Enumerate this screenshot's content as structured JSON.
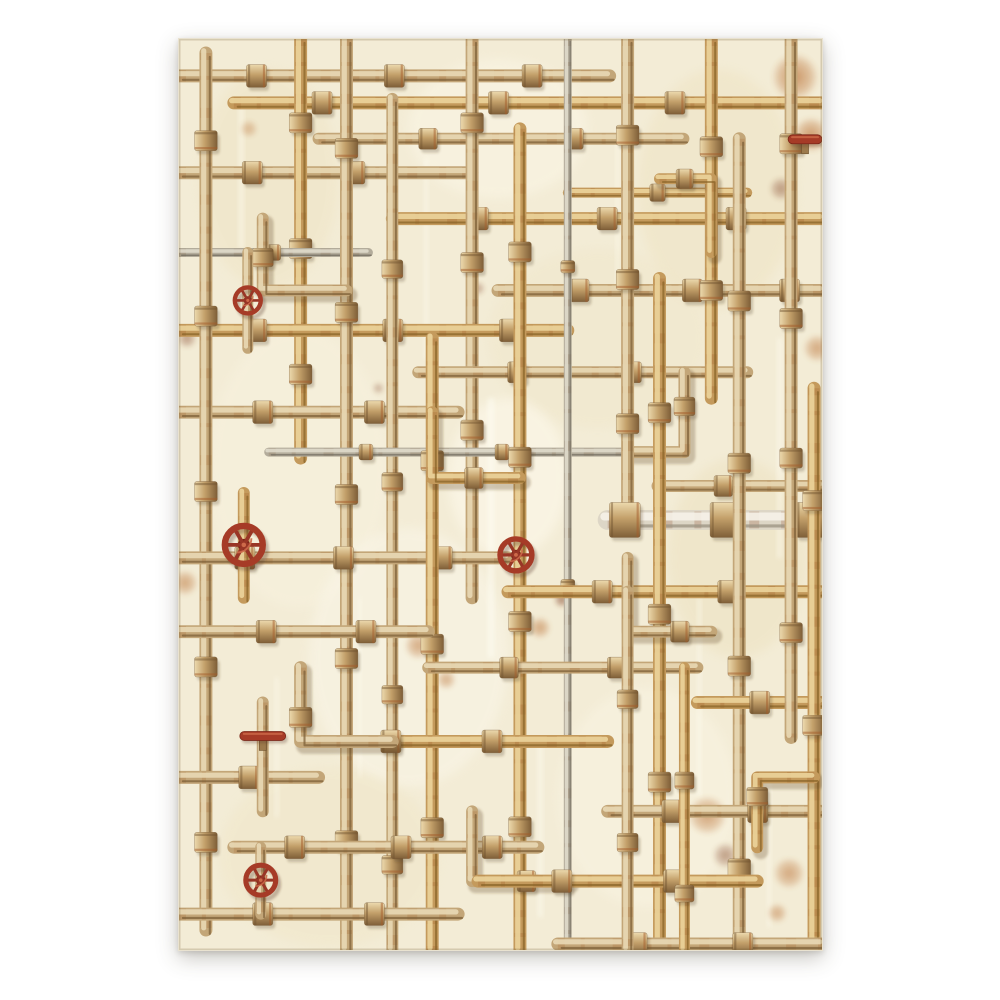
{
  "meta": {
    "description": "Decorative paper sheet with vintage rusty pipes, fittings and red valve wheels illustration on aged cream background"
  },
  "canvas": {
    "background": "#ffffff"
  },
  "sheet": {
    "x": 178,
    "y": 38,
    "width": 645,
    "height": 913,
    "background": "#f3ecd6"
  },
  "palette": {
    "tan": {
      "base": "#c3a678",
      "hi": "#e9d9b5",
      "dk": "#7d6038",
      "rust": "#a4622f"
    },
    "gold": {
      "base": "#c49a5c",
      "hi": "#ecd49b",
      "dk": "#8a6428",
      "rust": "#9c5526"
    },
    "gray": {
      "base": "#b3ac9b",
      "hi": "#dfdacb",
      "dk": "#6f6a5c",
      "rust": "#8a6a4a"
    },
    "white": {
      "base": "#ddd6c6",
      "hi": "#f6f2e8",
      "dk": "#9a9280",
      "rust": "#8d4526"
    },
    "valve_red": {
      "ring": "#a63b27",
      "dark": "#7c2718",
      "hi": "#cd6a4a"
    },
    "shadow": "rgba(92,70,40,0.28)",
    "stain_orange": "#b96f33",
    "stain_dark": "#7c3a1d",
    "paper_edge": "rgba(120,100,60,0.25)"
  },
  "texture": {
    "blotches": [
      {
        "x": 90,
        "y": 140,
        "rx": 70,
        "ry": 110,
        "c": "#efe4c4",
        "o": 0.5
      },
      {
        "x": 320,
        "y": 90,
        "rx": 90,
        "ry": 70,
        "c": "#faf5e4",
        "o": 0.6
      },
      {
        "x": 540,
        "y": 150,
        "rx": 80,
        "ry": 120,
        "c": "#eee2c0",
        "o": 0.45
      },
      {
        "x": 120,
        "y": 430,
        "rx": 90,
        "ry": 140,
        "c": "#f8f2df",
        "o": 0.5
      },
      {
        "x": 420,
        "y": 300,
        "rx": 110,
        "ry": 90,
        "c": "#efe5c8",
        "o": 0.4
      },
      {
        "x": 230,
        "y": 620,
        "rx": 100,
        "ry": 130,
        "c": "#faf6e8",
        "o": 0.55
      },
      {
        "x": 560,
        "y": 520,
        "rx": 70,
        "ry": 100,
        "c": "#ece0bd",
        "o": 0.45
      },
      {
        "x": 150,
        "y": 820,
        "rx": 110,
        "ry": 90,
        "c": "#f0e6c8",
        "o": 0.5
      },
      {
        "x": 470,
        "y": 760,
        "rx": 90,
        "ry": 110,
        "c": "#f9f4e3",
        "o": 0.5
      },
      {
        "x": 330,
        "y": 440,
        "rx": 60,
        "ry": 80,
        "c": "#fffbee",
        "o": 0.5
      }
    ],
    "streaks": [
      {
        "x": 60,
        "y": 60,
        "w": 5,
        "h": 150,
        "c": "#fffdf2",
        "o": 0.5
      },
      {
        "x": 246,
        "y": 120,
        "w": 4,
        "h": 200,
        "c": "#fffdf2",
        "o": 0.45
      },
      {
        "x": 310,
        "y": 360,
        "w": 6,
        "h": 260,
        "c": "#fffef6",
        "o": 0.5
      },
      {
        "x": 438,
        "y": 90,
        "w": 4,
        "h": 160,
        "c": "#fffdf0",
        "o": 0.4
      },
      {
        "x": 600,
        "y": 300,
        "w": 5,
        "h": 220,
        "c": "#fffdf2",
        "o": 0.45
      },
      {
        "x": 520,
        "y": 560,
        "w": 4,
        "h": 200,
        "c": "#fffef4",
        "o": 0.4
      },
      {
        "x": 180,
        "y": 560,
        "w": 3,
        "h": 180,
        "c": "#fffdf0",
        "o": 0.4
      },
      {
        "x": 360,
        "y": 700,
        "w": 5,
        "h": 180,
        "c": "#fffef4",
        "o": 0.45
      },
      {
        "x": 96,
        "y": 640,
        "w": 4,
        "h": 140,
        "c": "#fffdf2",
        "o": 0.4
      },
      {
        "x": 590,
        "y": 740,
        "w": 4,
        "h": 150,
        "c": "#fffdf2",
        "o": 0.4
      }
    ],
    "stains": [
      {
        "x": 618,
        "y": 38,
        "r": 24,
        "k": "o",
        "o": 0.75
      },
      {
        "x": 634,
        "y": 96,
        "r": 18,
        "k": "o",
        "o": 0.7
      },
      {
        "x": 604,
        "y": 150,
        "r": 12,
        "k": "d",
        "o": 0.5
      },
      {
        "x": 640,
        "y": 310,
        "r": 14,
        "k": "o",
        "o": 0.6
      },
      {
        "x": 8,
        "y": 300,
        "r": 10,
        "k": "d",
        "o": 0.5
      },
      {
        "x": 6,
        "y": 545,
        "r": 13,
        "k": "o",
        "o": 0.6
      },
      {
        "x": 384,
        "y": 562,
        "r": 8,
        "k": "d",
        "o": 0.65
      },
      {
        "x": 362,
        "y": 590,
        "r": 11,
        "k": "o",
        "o": 0.6
      },
      {
        "x": 240,
        "y": 608,
        "r": 14,
        "k": "o",
        "o": 0.6
      },
      {
        "x": 268,
        "y": 642,
        "r": 10,
        "k": "o",
        "o": 0.55
      },
      {
        "x": 530,
        "y": 778,
        "r": 20,
        "k": "o",
        "o": 0.65
      },
      {
        "x": 548,
        "y": 818,
        "r": 13,
        "k": "d",
        "o": 0.5
      },
      {
        "x": 612,
        "y": 836,
        "r": 16,
        "k": "o",
        "o": 0.6
      },
      {
        "x": 600,
        "y": 876,
        "r": 10,
        "k": "o",
        "o": 0.55
      },
      {
        "x": 300,
        "y": 250,
        "r": 7,
        "k": "d",
        "o": 0.45
      },
      {
        "x": 430,
        "y": 180,
        "r": 8,
        "k": "o",
        "o": 0.5
      },
      {
        "x": 70,
        "y": 90,
        "r": 9,
        "k": "o",
        "o": 0.45
      },
      {
        "x": 200,
        "y": 350,
        "r": 6,
        "k": "d",
        "o": 0.4
      }
    ]
  },
  "pipes": [
    {
      "pts": [
        [
          0,
          37
        ],
        [
          432,
          37
        ]
      ],
      "w": 13,
      "c": "tan",
      "joints": [
        0.18,
        0.5,
        0.82
      ]
    },
    {
      "pts": [
        [
          55,
          64
        ],
        [
          645,
          64
        ]
      ],
      "w": 13,
      "c": "gold",
      "joints": [
        0.15,
        0.45,
        0.75
      ]
    },
    {
      "pts": [
        [
          140,
          100
        ],
        [
          506,
          100
        ]
      ],
      "w": 12,
      "c": "tan",
      "joints": [
        0.3,
        0.7
      ]
    },
    {
      "pts": [
        [
          0,
          134
        ],
        [
          294,
          134
        ]
      ],
      "w": 13,
      "c": "tan",
      "joints": [
        0.25,
        0.6
      ]
    },
    {
      "pts": [
        [
          214,
          180
        ],
        [
          645,
          180
        ]
      ],
      "w": 13,
      "c": "gold",
      "joints": [
        0.2,
        0.5,
        0.8
      ]
    },
    {
      "pts": [
        [
          390,
          154
        ],
        [
          570,
          154
        ]
      ],
      "w": 10,
      "c": "gold",
      "joints": [
        0.5
      ]
    },
    {
      "pts": [
        [
          122,
          0
        ],
        [
          122,
          420
        ]
      ],
      "w": 13,
      "c": "gold",
      "joints": [
        0.2,
        0.5,
        0.8
      ]
    },
    {
      "pts": [
        [
          294,
          0
        ],
        [
          294,
          560
        ]
      ],
      "w": 13,
      "c": "tan",
      "joints": [
        0.15,
        0.4,
        0.7
      ]
    },
    {
      "pts": [
        [
          0,
          214
        ],
        [
          190,
          214
        ]
      ],
      "w": 9,
      "c": "gray",
      "joints": [
        0.5
      ]
    },
    {
      "pts": [
        [
          320,
          252
        ],
        [
          645,
          252
        ]
      ],
      "w": 13,
      "c": "tan",
      "joints": [
        0.25,
        0.6,
        0.9
      ]
    },
    {
      "pts": [
        [
          0,
          292
        ],
        [
          390,
          292
        ]
      ],
      "w": 13,
      "c": "gold",
      "joints": [
        0.2,
        0.55,
        0.85
      ]
    },
    {
      "pts": [
        [
          240,
          334
        ],
        [
          570,
          334
        ]
      ],
      "w": 12,
      "c": "tan",
      "joints": [
        0.3,
        0.65
      ]
    },
    {
      "pts": [
        [
          0,
          374
        ],
        [
          280,
          374
        ]
      ],
      "w": 13,
      "c": "tan",
      "joints": [
        0.3,
        0.7
      ]
    },
    {
      "pts": [
        [
          27,
          14
        ],
        [
          27,
          893
        ]
      ],
      "w": 13,
      "c": "tan",
      "joints": [
        0.1,
        0.3,
        0.5,
        0.7,
        0.9
      ]
    },
    {
      "pts": [
        [
          168,
          0
        ],
        [
          168,
          913
        ]
      ],
      "w": 13,
      "c": "tan",
      "joints": [
        0.12,
        0.3,
        0.5,
        0.68,
        0.88
      ]
    },
    {
      "pts": [
        [
          214,
          60
        ],
        [
          214,
          913
        ]
      ],
      "w": 12,
      "c": "tan",
      "joints": [
        0.2,
        0.45,
        0.7,
        0.9
      ]
    },
    {
      "pts": [
        [
          90,
          414
        ],
        [
          480,
          414
        ]
      ],
      "w": 9,
      "c": "gray",
      "joints": [
        0.25,
        0.6
      ]
    },
    {
      "pts": [
        [
          480,
          448
        ],
        [
          645,
          448
        ]
      ],
      "w": 12,
      "c": "tan",
      "joints": [
        0.4
      ]
    },
    {
      "pts": [
        [
          0,
          520
        ],
        [
          330,
          520
        ]
      ],
      "w": 13,
      "c": "tan",
      "joints": [
        0.2,
        0.5,
        0.8
      ]
    },
    {
      "pts": [
        [
          254,
          300
        ],
        [
          254,
          913
        ]
      ],
      "w": 13,
      "c": "gold",
      "joints": [
        0.2,
        0.5,
        0.8
      ]
    },
    {
      "pts": [
        [
          342,
          90
        ],
        [
          342,
          913
        ]
      ],
      "w": 13,
      "c": "gold",
      "joints": [
        0.15,
        0.4,
        0.6,
        0.85
      ]
    },
    {
      "pts": [
        [
          390,
          0
        ],
        [
          390,
          913
        ]
      ],
      "w": 8,
      "c": "gray",
      "joints": [
        0.25,
        0.6
      ]
    },
    {
      "pts": [
        [
          84,
          180
        ],
        [
          84,
          252
        ],
        [
          168,
          252
        ]
      ],
      "w": 12,
      "c": "tan",
      "joints": [
        0.25
      ]
    },
    {
      "pts": [
        [
          254,
          374
        ],
        [
          254,
          440
        ],
        [
          342,
          440
        ]
      ],
      "w": 12,
      "c": "gold",
      "joints": [
        0.7
      ]
    },
    {
      "pts": [
        [
          450,
          414
        ],
        [
          507,
          414
        ],
        [
          507,
          334
        ]
      ],
      "w": 12,
      "c": "tan",
      "joints": [
        0.75
      ]
    },
    {
      "pts": [
        [
          330,
          554
        ],
        [
          645,
          554
        ]
      ],
      "w": 13,
      "c": "gold",
      "joints": [
        0.3,
        0.7
      ]
    },
    {
      "pts": [
        [
          0,
          594
        ],
        [
          250,
          594
        ]
      ],
      "w": 13,
      "c": "tan",
      "joints": [
        0.35,
        0.75
      ]
    },
    {
      "pts": [
        [
          250,
          630
        ],
        [
          520,
          630
        ]
      ],
      "w": 12,
      "c": "tan",
      "joints": [
        0.3,
        0.7
      ]
    },
    {
      "pts": [
        [
          450,
          0
        ],
        [
          450,
          482
        ]
      ],
      "w": 13,
      "c": "tan",
      "joints": [
        0.2,
        0.5,
        0.8
      ]
    },
    {
      "pts": [
        [
          534,
          0
        ],
        [
          534,
          360
        ]
      ],
      "w": 13,
      "c": "gold",
      "joints": [
        0.3,
        0.7
      ]
    },
    {
      "pts": [
        [
          430,
          482
        ],
        [
          645,
          482
        ]
      ],
      "w": 20,
      "c": "white",
      "joints": [
        0.08,
        0.55,
        0.95
      ]
    },
    {
      "pts": [
        [
          482,
          240
        ],
        [
          482,
          913
        ]
      ],
      "w": 13,
      "c": "gold",
      "joints": [
        0.2,
        0.5,
        0.75
      ]
    },
    {
      "pts": [
        [
          562,
          100
        ],
        [
          562,
          913
        ]
      ],
      "w": 13,
      "c": "tan",
      "joints": [
        0.2,
        0.4,
        0.65,
        0.9
      ]
    },
    {
      "pts": [
        [
          520,
          665
        ],
        [
          645,
          665
        ]
      ],
      "w": 13,
      "c": "gold",
      "joints": [
        0.5
      ]
    },
    {
      "pts": [
        [
          140,
          704
        ],
        [
          430,
          704
        ]
      ],
      "w": 13,
      "c": "gold",
      "joints": [
        0.25,
        0.6
      ]
    },
    {
      "pts": [
        [
          0,
          740
        ],
        [
          140,
          740
        ]
      ],
      "w": 13,
      "c": "tan",
      "joints": [
        0.5
      ]
    },
    {
      "pts": [
        [
          450,
          520
        ],
        [
          450,
          594
        ],
        [
          534,
          594
        ]
      ],
      "w": 12,
      "c": "tan",
      "joints": [
        0.8
      ]
    },
    {
      "pts": [
        [
          482,
          140
        ],
        [
          534,
          140
        ],
        [
          534,
          214
        ]
      ],
      "w": 11,
      "c": "gold",
      "joints": [
        0.2
      ]
    },
    {
      "pts": [
        [
          122,
          630
        ],
        [
          122,
          704
        ],
        [
          214,
          704
        ]
      ],
      "w": 13,
      "c": "tan",
      "joints": [
        0.3
      ]
    },
    {
      "pts": [
        [
          430,
          774
        ],
        [
          645,
          774
        ]
      ],
      "w": 13,
      "c": "tan",
      "joints": [
        0.3,
        0.7
      ]
    },
    {
      "pts": [
        [
          55,
          810
        ],
        [
          360,
          810
        ]
      ],
      "w": 13,
      "c": "tan",
      "joints": [
        0.2,
        0.55,
        0.85
      ]
    },
    {
      "pts": [
        [
          614,
          0
        ],
        [
          614,
          700
        ]
      ],
      "w": 13,
      "c": "tan",
      "joints": [
        0.15,
        0.4,
        0.6,
        0.85
      ]
    },
    {
      "pts": [
        [
          637,
          350
        ],
        [
          637,
          913
        ]
      ],
      "w": 13,
      "c": "gold",
      "joints": [
        0.2,
        0.6
      ]
    },
    {
      "pts": [
        [
          294,
          774
        ],
        [
          294,
          844
        ],
        [
          390,
          844
        ]
      ],
      "w": 12,
      "c": "tan",
      "joints": [
        0.75
      ]
    },
    {
      "pts": [
        [
          637,
          740
        ],
        [
          580,
          740
        ],
        [
          580,
          810
        ]
      ],
      "w": 12,
      "c": "gold",
      "joints": [
        0.6
      ]
    },
    {
      "pts": [
        [
          300,
          844
        ],
        [
          580,
          844
        ]
      ],
      "w": 13,
      "c": "gold",
      "joints": [
        0.3,
        0.7
      ]
    },
    {
      "pts": [
        [
          0,
          877
        ],
        [
          280,
          877
        ]
      ],
      "w": 13,
      "c": "tan",
      "joints": [
        0.3,
        0.7
      ]
    },
    {
      "pts": [
        [
          380,
          907
        ],
        [
          645,
          907
        ]
      ],
      "w": 13,
      "c": "tan",
      "joints": [
        0.3,
        0.7
      ]
    },
    {
      "pts": [
        [
          450,
          554
        ],
        [
          450,
          913
        ]
      ],
      "w": 12,
      "c": "tan",
      "joints": [
        0.3,
        0.7
      ]
    },
    {
      "pts": [
        [
          507,
          630
        ],
        [
          507,
          913
        ]
      ],
      "w": 11,
      "c": "gold",
      "joints": [
        0.4,
        0.8
      ]
    },
    {
      "pts": [
        [
          84,
          665
        ],
        [
          84,
          774
        ]
      ],
      "w": 12,
      "c": "tan",
      "joints": []
    },
    {
      "pts": [
        [
          65,
          455
        ],
        [
          65,
          560
        ]
      ],
      "w": 12,
      "c": "gold",
      "joints": []
    },
    {
      "pts": [
        [
          69,
          214
        ],
        [
          69,
          310
        ]
      ],
      "w": 11,
      "c": "tan",
      "joints": []
    },
    {
      "pts": [
        [
          82,
          810
        ],
        [
          82,
          877
        ]
      ],
      "w": 11,
      "c": "tan",
      "joints": []
    }
  ],
  "valves": [
    {
      "type": "wheel",
      "x": 69,
      "y": 262,
      "r": 13
    },
    {
      "type": "wheel",
      "x": 65,
      "y": 507,
      "r": 19
    },
    {
      "type": "wheel",
      "x": 338,
      "y": 517,
      "r": 16
    },
    {
      "type": "wheel",
      "x": 82,
      "y": 843,
      "r": 15
    },
    {
      "type": "lever",
      "x": 84,
      "y": 700,
      "len": 46
    },
    {
      "type": "lever",
      "x": 628,
      "y": 102,
      "len": 34
    }
  ]
}
